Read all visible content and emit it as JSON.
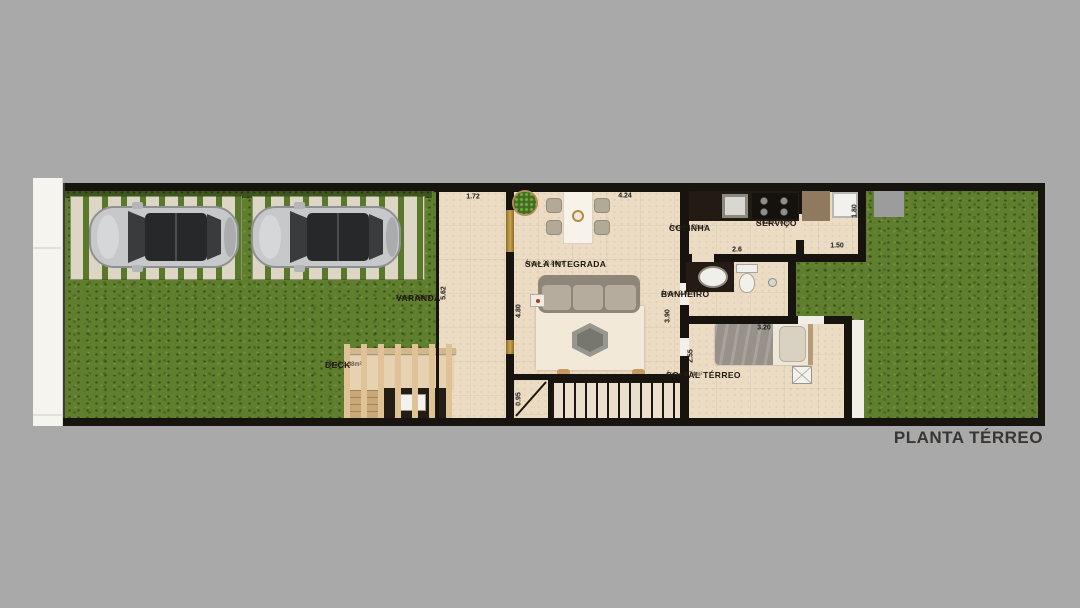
{
  "title": "PLANTA TÉRREO",
  "rooms": [
    {
      "name": "VARANDA",
      "area": "Área= 7.46m²"
    },
    {
      "name": "SALA INTEGRADA",
      "area": "Área= 20.86m²"
    },
    {
      "name": "COZINHA",
      "area": "Área= 4.70m²"
    },
    {
      "name": "SERVIÇO",
      "area": "Área= 2.70m²"
    },
    {
      "name": "BANHEIRO",
      "area": "Área= 2.98m²"
    },
    {
      "name": "SOCIAL TÉRREO",
      "area": "Área= 8.74m²"
    },
    {
      "name": "DECK",
      "area": "Área= 3.38m²"
    }
  ],
  "dims": {
    "varanda_width": "1.72",
    "sala_width": "4.24",
    "varanda_depth": "5.62",
    "sala_depth": "4.80",
    "hall_depth": "3.90",
    "stair_width": "0.95",
    "cozinha_width": "2.6",
    "servico_depth": "1.80",
    "servico_width": "1.50",
    "social_width": "3.20",
    "social_depth": "2.55"
  },
  "colors": {
    "background": "#a9a9a9",
    "wall": "#17130e",
    "floor": "#ecdcc4",
    "grass": "#5f7e2e",
    "gold_accent": "#b08d3f"
  }
}
